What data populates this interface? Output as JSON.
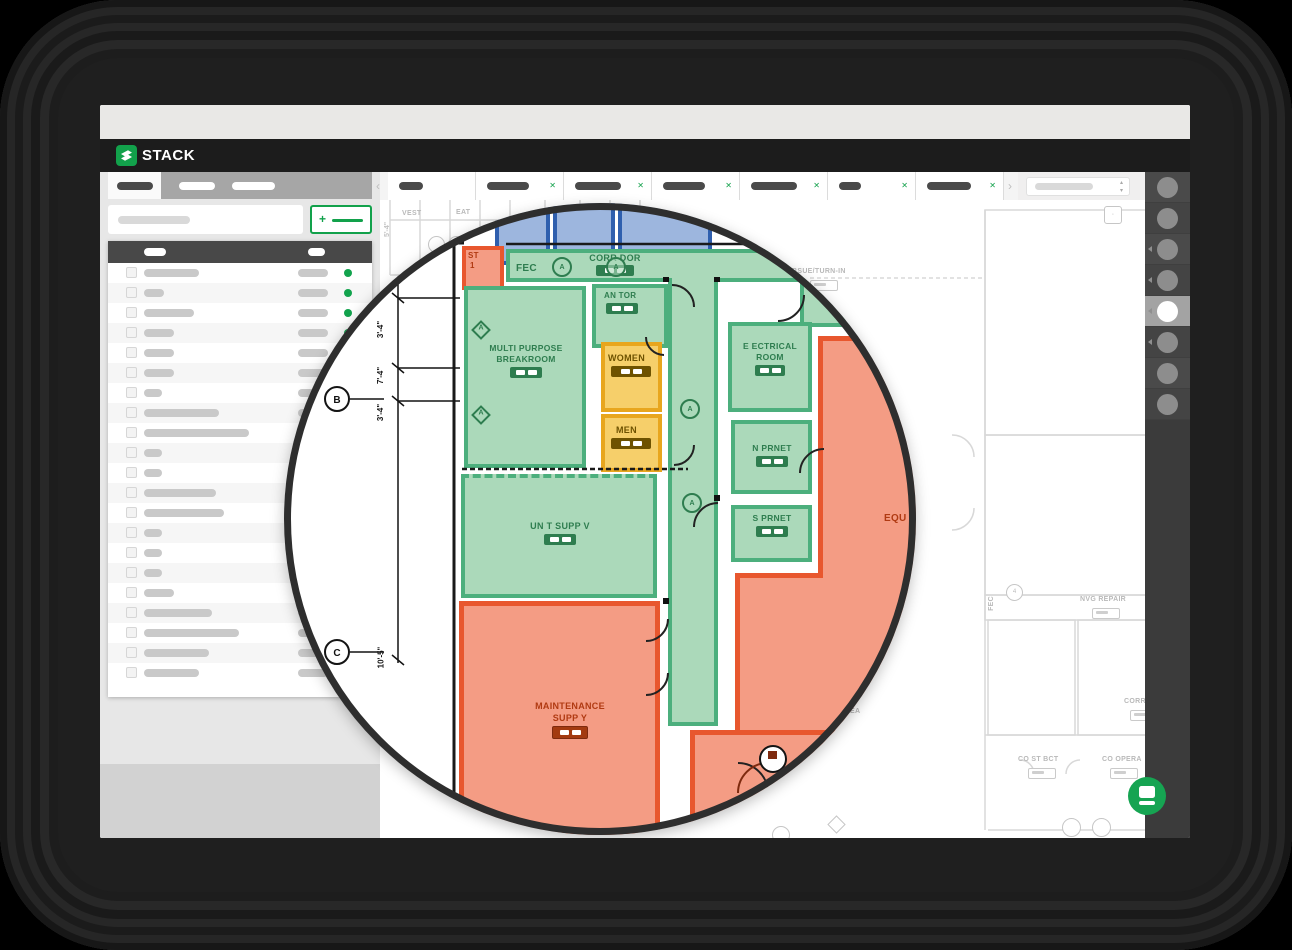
{
  "chrome": {
    "traffic_lights": [
      "#e9756e",
      "#eac14d",
      "#8bcb8b"
    ]
  },
  "navbar": {
    "brand": "STACK",
    "brand_color": "#12a14b",
    "menu_pills": [
      {
        "w": 29,
        "color": "#ffffff"
      },
      {
        "w": 38,
        "color": "#ffffff"
      },
      {
        "w": 28,
        "color": "#f0b429"
      },
      {
        "w": 54,
        "color": "#ffffff"
      },
      {
        "w": 38,
        "color": "#ffffff"
      }
    ],
    "avatar_caret": "▾"
  },
  "sidebar": {
    "add_button_plus": "+",
    "rows": [
      {
        "name_w": 55
      },
      {
        "name_w": 20
      },
      {
        "name_w": 50
      },
      {
        "name_w": 30
      },
      {
        "name_w": 30
      },
      {
        "name_w": 30
      },
      {
        "name_w": 18
      },
      {
        "name_w": 75
      },
      {
        "name_w": 105
      },
      {
        "name_w": 18
      },
      {
        "name_w": 18
      },
      {
        "name_w": 72
      },
      {
        "name_w": 80
      },
      {
        "name_w": 18
      },
      {
        "name_w": 18
      },
      {
        "name_w": 18
      },
      {
        "name_w": 30
      },
      {
        "name_w": 68
      },
      {
        "name_w": 95
      },
      {
        "name_w": 65
      },
      {
        "name_w": 55
      }
    ],
    "value_pill_w": 30
  },
  "plan_tabs": {
    "left_chevron": "‹",
    "right_chevron": "›",
    "close_glyph": "✕",
    "tabs": [
      {
        "pill_w": 24,
        "closable": false
      },
      {
        "pill_w": 42,
        "closable": true
      },
      {
        "pill_w": 46,
        "closable": true
      },
      {
        "pill_w": 42,
        "closable": true
      },
      {
        "pill_w": 46,
        "closable": true
      },
      {
        "pill_w": 22,
        "closable": true
      },
      {
        "pill_w": 44,
        "closable": true
      }
    ],
    "spinner_up": "▴",
    "spinner_down": "▾"
  },
  "toolbar": {
    "items": [
      {
        "caret": false,
        "active": false
      },
      {
        "caret": false,
        "active": false
      },
      {
        "caret": true,
        "active": false
      },
      {
        "caret": true,
        "active": false
      },
      {
        "caret": true,
        "active": true
      },
      {
        "caret": true,
        "active": false
      },
      {
        "caret": false,
        "active": false
      },
      {
        "caret": false,
        "active": false
      }
    ]
  },
  "lens": {
    "rooms": {
      "corridor": "CORR DOR",
      "fec": "FEC",
      "stair_line1": "ST",
      "stair_line2": "1",
      "janitor": "AN TOR",
      "breakroom_line1": "MULTI PURPOSE",
      "breakroom_line2": "BREAKROOM",
      "women": "WOMEN",
      "men": "MEN",
      "electrical_line1": "E ECTRICAL",
      "electrical_line2": "ROOM",
      "n_prnet": "N PRNET",
      "s_prnet": "S PRNET",
      "unit_supply": "UN T SUPP V",
      "equipment": "EQU",
      "maintenance_line1": "MAINTENANCE",
      "maintenance_line2": "SUPP Y"
    },
    "dimensions": [
      "3'-4\"",
      "7'-4\"",
      "3'-4\"",
      "10'-5\""
    ],
    "grid_bubbles": [
      "B",
      "C"
    ],
    "door_tag": "A",
    "colors": {
      "green_fill": "#abd9ba",
      "green_border": "#4caf7d",
      "orange_fill": "#f49c84",
      "orange_border": "#e8572e",
      "yellow_fill": "#f6cf6a",
      "yellow_border": "#e8a61e",
      "blue_fill": "#9db6de",
      "blue_border": "#2f5fae"
    }
  },
  "bg_plan": {
    "labels": {
      "issue": "BSUE/TURN-IN",
      "nvg": "NVG REPAIR",
      "corr": "CORR",
      "co_st": "CO ST BCT",
      "co_op": "CO OPERA",
      "fec": "FEC",
      "ea": "EA",
      "vest": "VEST",
      "eat": "EAT",
      "dim": "5'-4\"",
      "circ4": "4",
      "diamond_c": "C"
    }
  },
  "accent_green": "#12a14b"
}
